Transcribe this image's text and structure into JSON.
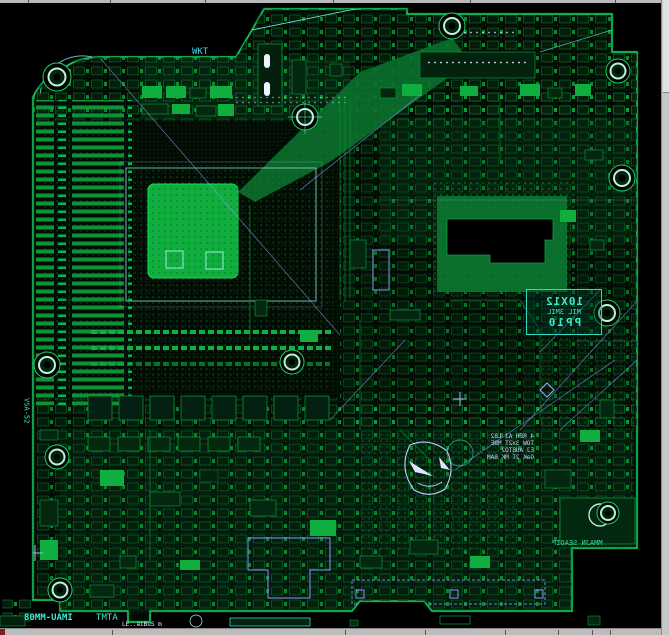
{
  "app": {
    "type": "pcb-layout-viewer",
    "description": "PCB motherboard layout open in an EDA viewer canvas"
  },
  "colors": {
    "background": "#000000",
    "board_edge_green": "#17d768",
    "copper_bright": "#0fae3f",
    "copper_mid": "#0d8f3a",
    "copper_dim": "#0a6f2c",
    "annotation_cyan": "#3fe8cc",
    "ratline_blue": "#96a0ff",
    "chrome_gray": "#c0c0c0"
  },
  "annotations": {
    "via_note": {
      "line1": "10X12",
      "line2": "MIL 3MIL",
      "line3": "PP10"
    },
    "wkt_label": "WKT",
    "left_vertical_label": "VSA-52",
    "bottom_left_label": "IMAU-MM08",
    "bottom_left_label_2": "ATMT",
    "bottom_left_small": "LE..aiBuS m",
    "bottom_right_label": "MMAJN SEAOIP",
    "note_block": {
      "line1": "4 REH AJ LB2",
      "line2": "TOW 3x2T MBE",
      "line3": "EJ AUBTO2",
      "line4": "OaK 2T MK BAM"
    }
  }
}
